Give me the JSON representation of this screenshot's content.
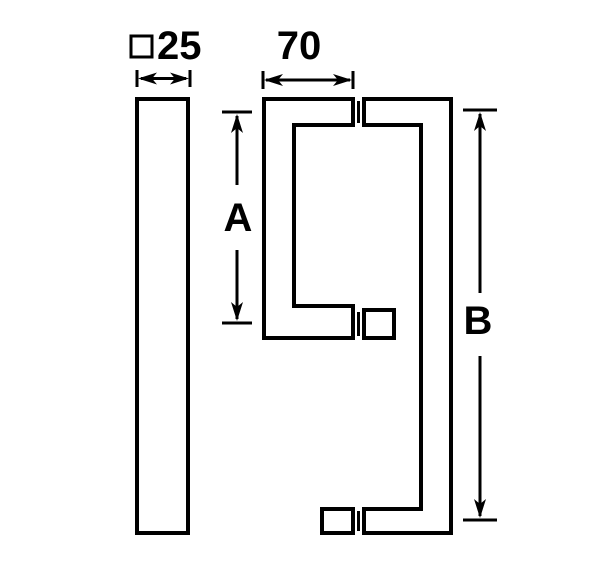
{
  "canvas": {
    "background_color": "#ffffff",
    "line_color": "#000000",
    "fill_color": "#ffffff"
  },
  "dimensions": {
    "profile": {
      "symbol": "square-outline",
      "value": "25"
    },
    "grip_width": {
      "value": "70"
    },
    "spacing_a": {
      "label": "A"
    },
    "spacing_b": {
      "label": "B"
    }
  }
}
